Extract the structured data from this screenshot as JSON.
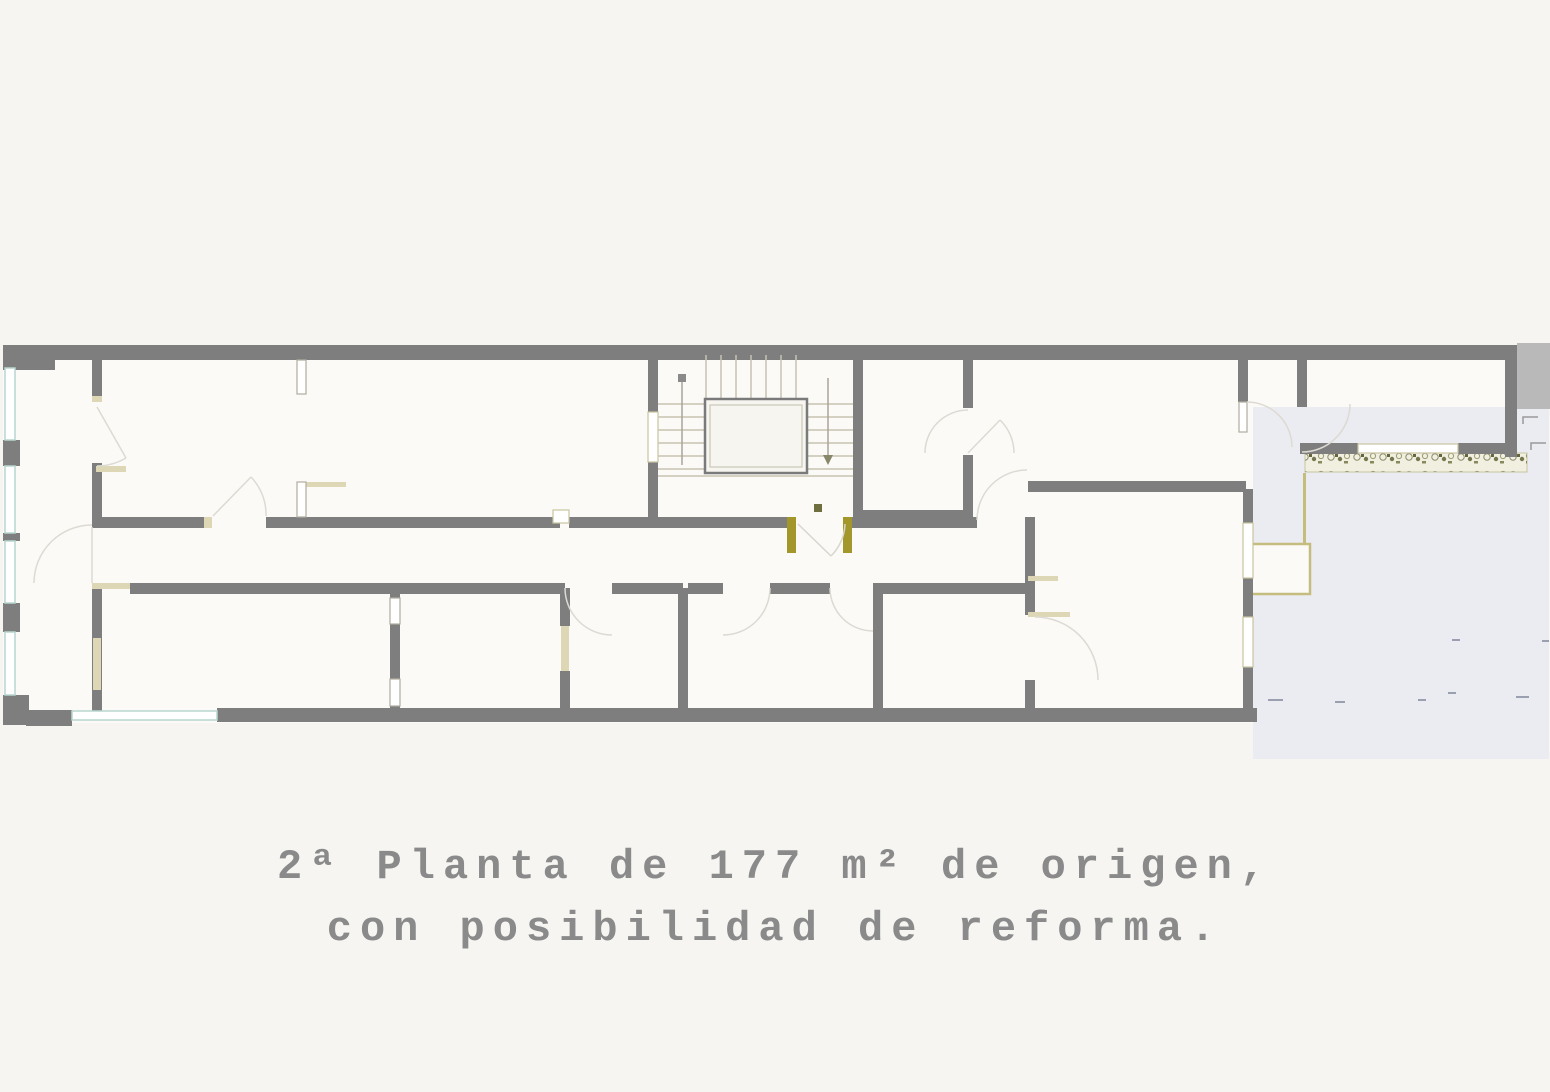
{
  "caption": {
    "line1": "2ª Planta de 177 m² de origen,",
    "line2": "con posibilidad de reforma."
  },
  "plan": {
    "floor_number": "2ª",
    "area_m2": "177",
    "note": "de origen, con posibilidad de reforma"
  },
  "colors": {
    "background": "#f6f5f2",
    "room_fill": "#fbfaf7",
    "stair_fill": "#f7f5ef",
    "wall": "#7e7e7e",
    "neighbor_gray": "#b9b9b9",
    "terrace_floor": "#ebecf1",
    "window_teal": "#b7d6cf",
    "jamb_beige": "#ddd7b6",
    "accent_olive": "#a3972c",
    "olive_light": "#c5bd7e",
    "tread_line": "#c7c3b2",
    "door_arc": "#dcdad2",
    "leaf_stroke": "#b0ac9e",
    "caption_text": "#8a8a8a",
    "mark_dark": "#6e6e3e"
  }
}
